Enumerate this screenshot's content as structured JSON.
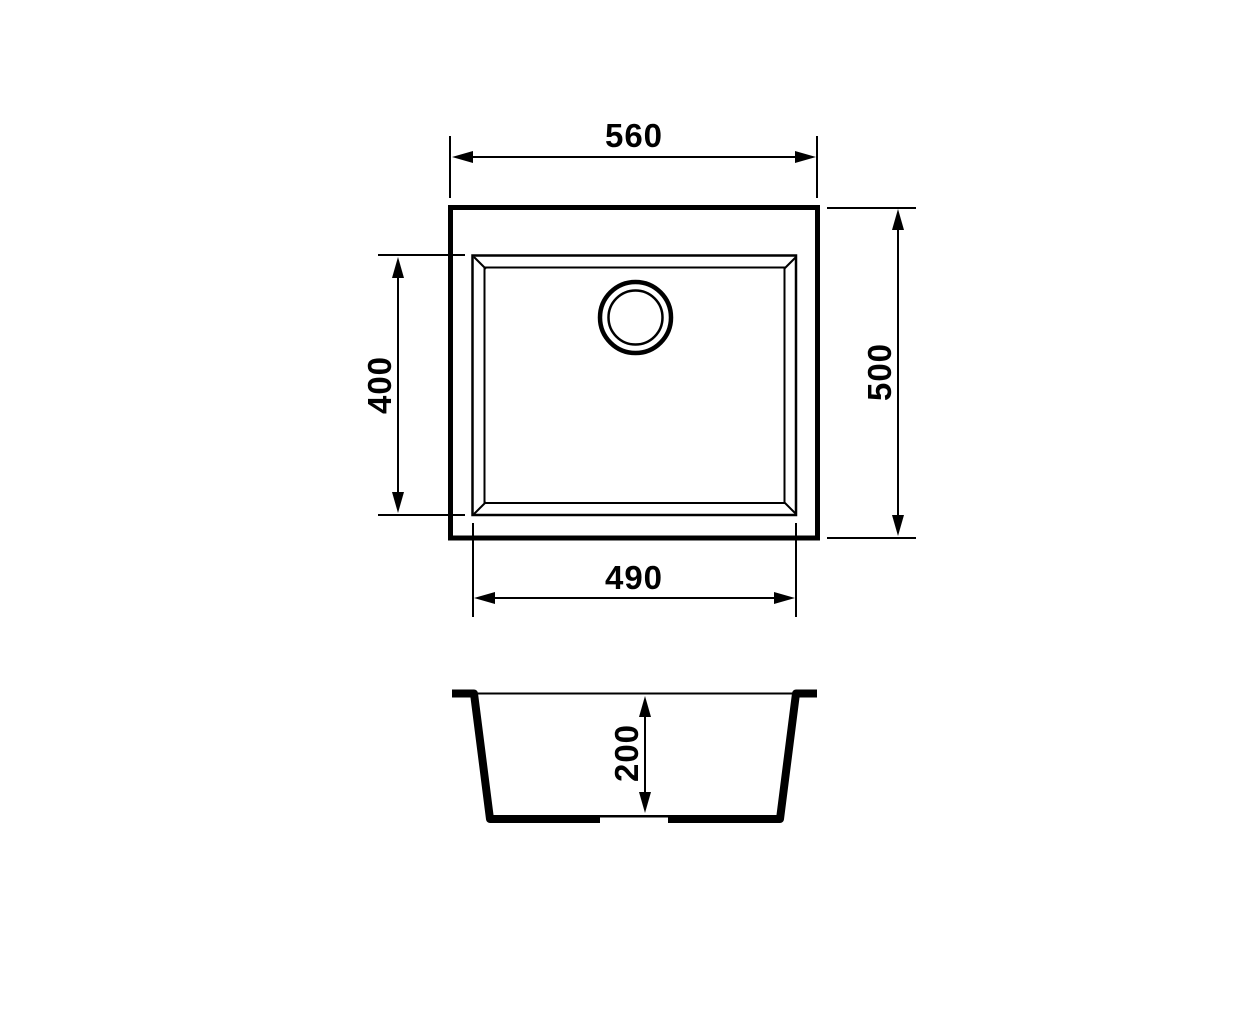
{
  "diagram": {
    "type": "technical-drawing",
    "subject": "Undermount sink dimension drawing: plan view and cross-section",
    "units": "mm",
    "colors": {
      "line": "#000000",
      "background": "#ffffff"
    },
    "top_view": {
      "overall_width": "560",
      "overall_depth": "500",
      "bowl_width": "490",
      "bowl_depth": "400"
    },
    "section_view": {
      "bowl_height": "200"
    }
  }
}
